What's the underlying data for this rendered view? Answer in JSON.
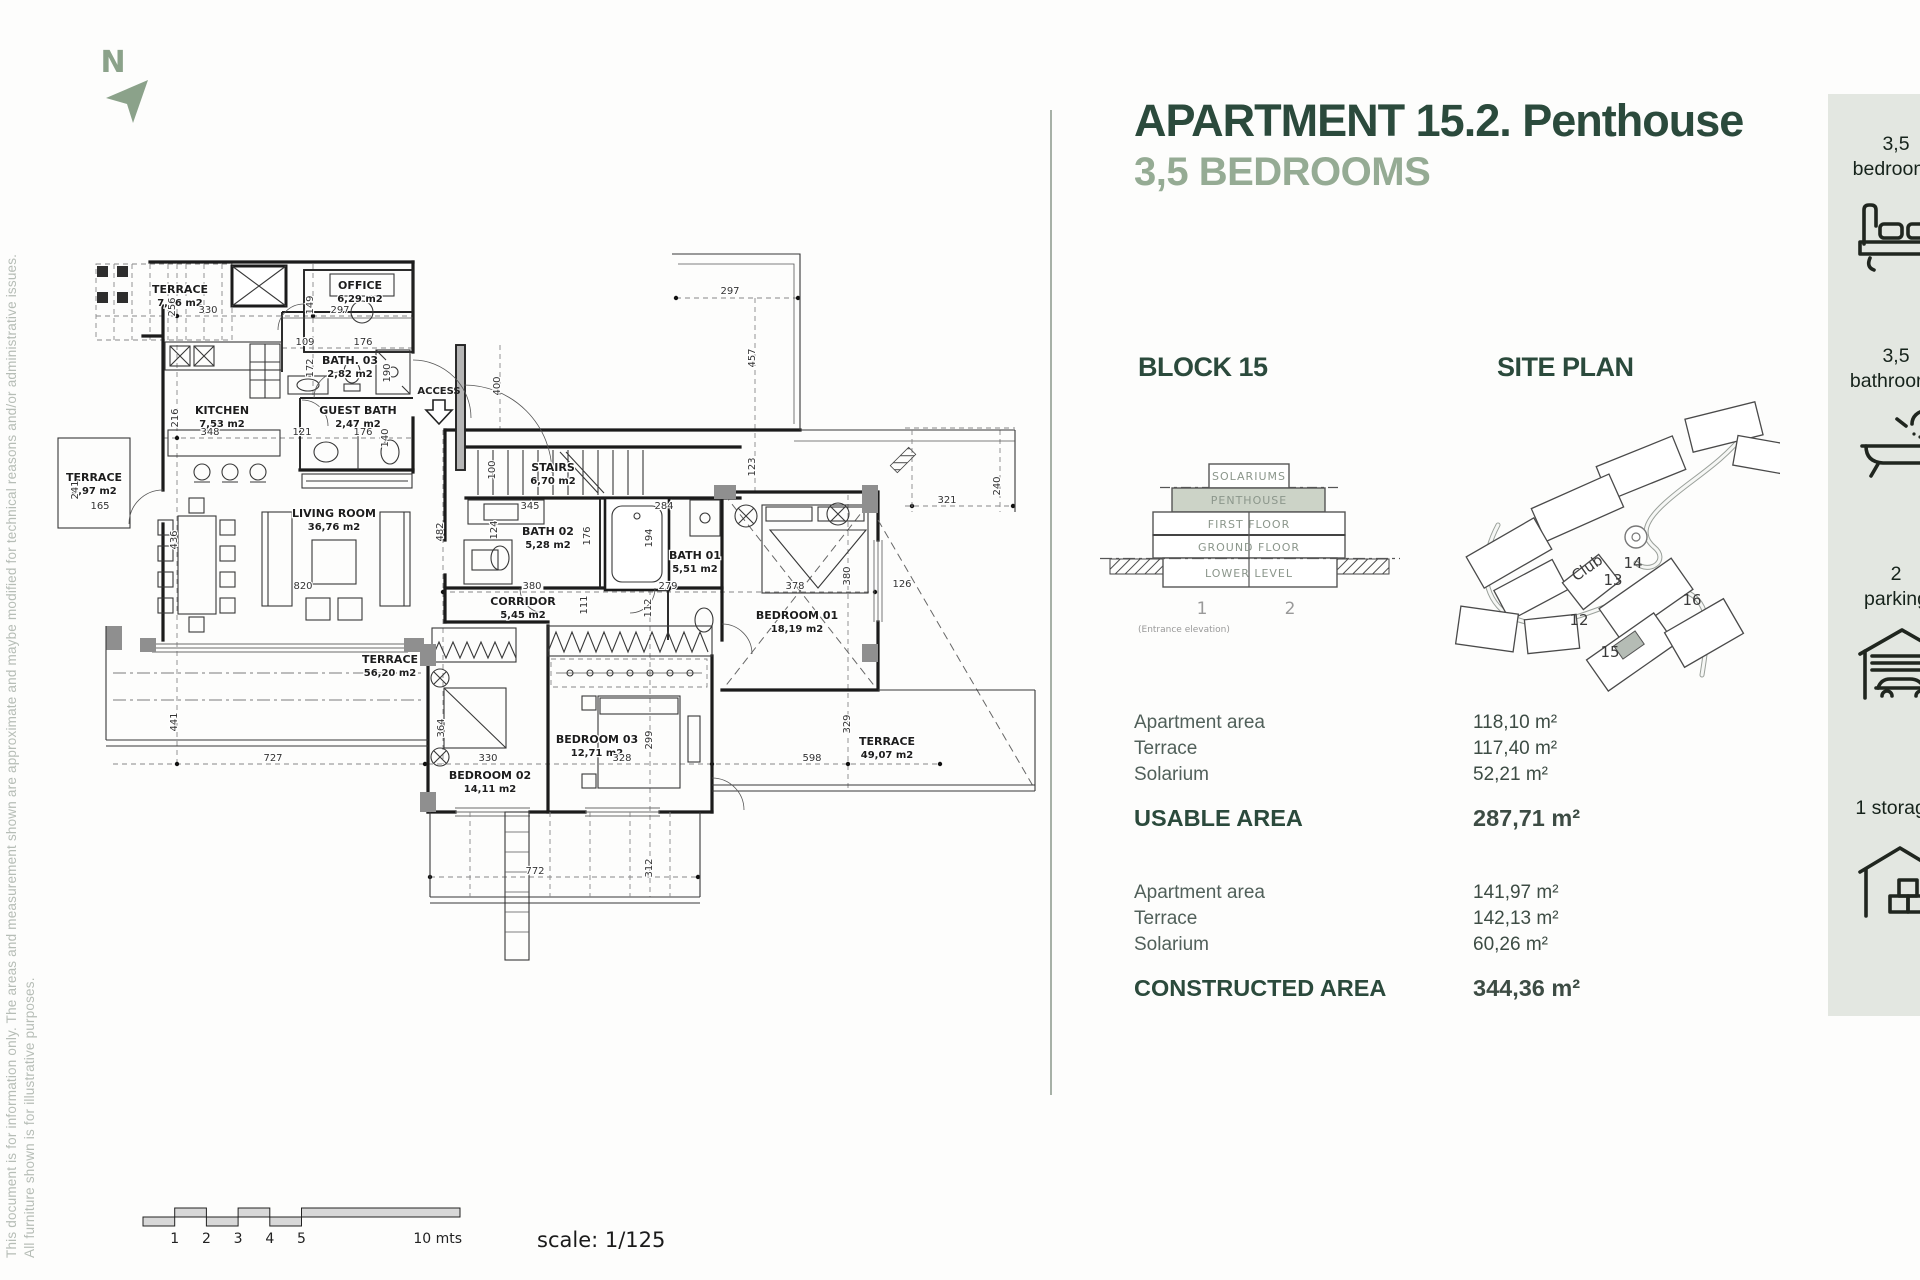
{
  "header": {
    "title": "APARTMENT 15.2. Penthouse",
    "subtitle": "3,5 BEDROOMS"
  },
  "disclaimer": {
    "line1": "This document is for information only. The areas and measurement shown are approximate and maybe modified for technical reasons and/or administrative issues.",
    "line2": "All furniture shown is for illustrative purposes."
  },
  "block_section": {
    "heading": "BLOCK 15",
    "levels": [
      "SOLARIUMS",
      "PENTHOUSE",
      "FIRST FLOOR",
      "GROUND FLOOR",
      "LOWER LEVEL"
    ],
    "unit_numbers": [
      "1",
      "2"
    ],
    "caption": "(Entrance elevation)"
  },
  "site_plan": {
    "heading": "SITE PLAN",
    "labels": {
      "club": "Club",
      "b12": "12",
      "b13": "13",
      "b14": "14",
      "b15": "15",
      "b16": "16"
    }
  },
  "usable": {
    "rows": [
      {
        "label": "Apartment area",
        "value": "118,10 m²"
      },
      {
        "label": "Terrace",
        "value": "117,40 m²"
      },
      {
        "label": "Solarium",
        "value": "52,21 m²"
      }
    ],
    "total_label": "USABLE AREA",
    "total_value": "287,71 m²"
  },
  "constructed": {
    "rows": [
      {
        "label": "Apartment area",
        "value": "141,97 m²"
      },
      {
        "label": "Terrace",
        "value": "142,13 m²"
      },
      {
        "label": "Solarium",
        "value": "60,26 m²"
      }
    ],
    "total_label": "CONSTRUCTED AREA",
    "total_value": "344,36 m²"
  },
  "sidebar": {
    "items": [
      {
        "line1": "3,5",
        "line2": "bedrooms",
        "icon": "bed-icon"
      },
      {
        "line1": "3,5",
        "line2": "bathrooms",
        "icon": "bathtub-icon"
      },
      {
        "line1": "2",
        "line2": "parking",
        "icon": "car-garage-icon"
      },
      {
        "line1": "1 storage",
        "line2": "",
        "icon": "storage-icon"
      }
    ]
  },
  "floor_plan": {
    "north": "N",
    "access": "ACCESS",
    "rooms": [
      {
        "name": "TERRACE",
        "area": "7,56 m2"
      },
      {
        "name": "OFFICE",
        "area": "6,29 m2"
      },
      {
        "name": "BATH. 03",
        "area": "2,82 m2"
      },
      {
        "name": "KITCHEN",
        "area": "7,53 m2"
      },
      {
        "name": "GUEST BATH",
        "area": "2,47 m2"
      },
      {
        "name": "TERRACE",
        "area": "3,97 m2"
      },
      {
        "name": "LIVING ROOM",
        "area": "36,76 m2"
      },
      {
        "name": "STAIRS",
        "area": "6,70 m2"
      },
      {
        "name": "BATH 02",
        "area": "5,28 m2"
      },
      {
        "name": "BATH 01",
        "area": "5,51 m2"
      },
      {
        "name": "CORRIDOR",
        "area": "5,45 m2"
      },
      {
        "name": "BEDROOM 01",
        "area": "18,19 m2"
      },
      {
        "name": "TERRACE",
        "area": "56,20 m2"
      },
      {
        "name": "BEDROOM 02",
        "area": "14,11 m2"
      },
      {
        "name": "BEDROOM 03",
        "area": "12,71 m2"
      },
      {
        "name": "TERRACE",
        "area": "49,07 m2"
      }
    ],
    "dims": [
      "256",
      "330",
      "149",
      "297",
      "109",
      "176",
      "172",
      "190",
      "216",
      "348",
      "121",
      "176",
      "140",
      "241",
      "165",
      "436",
      "820",
      "482",
      "297",
      "457",
      "123",
      "321",
      "240",
      "400",
      "100",
      "345",
      "124",
      "176",
      "194",
      "284",
      "380",
      "279",
      "111",
      "112",
      "378",
      "380",
      "441",
      "727",
      "330",
      "364",
      "299",
      "328",
      "598",
      "329",
      "312",
      "772",
      "126"
    ]
  },
  "scale_bar": {
    "ticks": [
      "1",
      "2",
      "3",
      "4",
      "5"
    ],
    "end_label": "10 mts",
    "scale_label": "scale: 1/125"
  }
}
